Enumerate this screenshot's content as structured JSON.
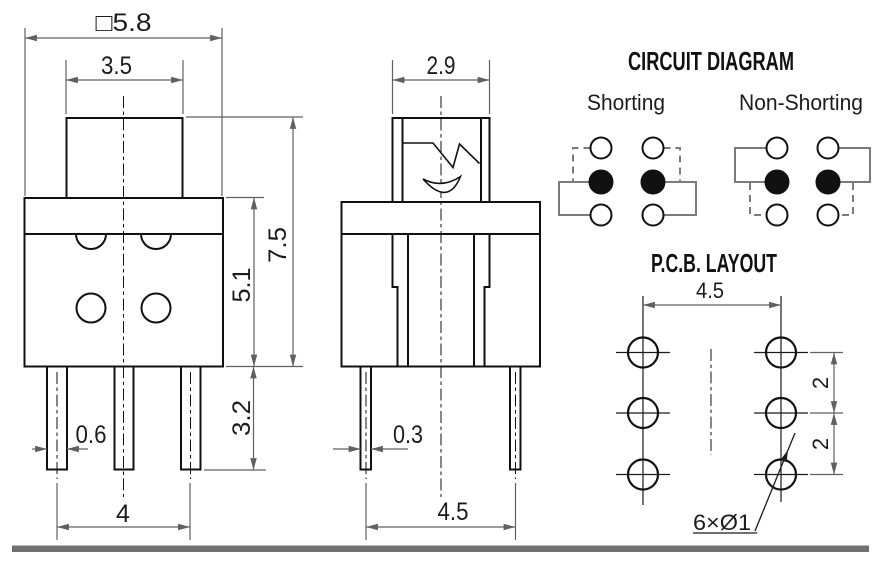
{
  "front_view": {
    "dim_overall_width": "□5.8",
    "dim_cap_width": "3.5",
    "dim_overall_height": "7.5",
    "dim_body_height": "5.1",
    "dim_pin_length": "3.2",
    "dim_pin_width": "0.6",
    "dim_pin_span": "4"
  },
  "side_view": {
    "dim_cap_width": "2.9",
    "dim_pin_width": "0.3",
    "dim_pin_span": "4.5"
  },
  "circuit_diagram": {
    "title": "CIRCUIT DIAGRAM",
    "shorting_label": "Shorting",
    "non_shorting_label": "Non-Shorting"
  },
  "pcb_layout": {
    "title": "P.C.B. LAYOUT",
    "dim_column_span": "4.5",
    "dim_row_pitch_top": "2",
    "dim_row_pitch_bottom": "2",
    "hole_callout": "6×Ø1"
  },
  "colors": {
    "line": "#111111",
    "dimension": "#606060",
    "circuit_link": "#7b7b7b",
    "footer_bar": "#707070"
  }
}
